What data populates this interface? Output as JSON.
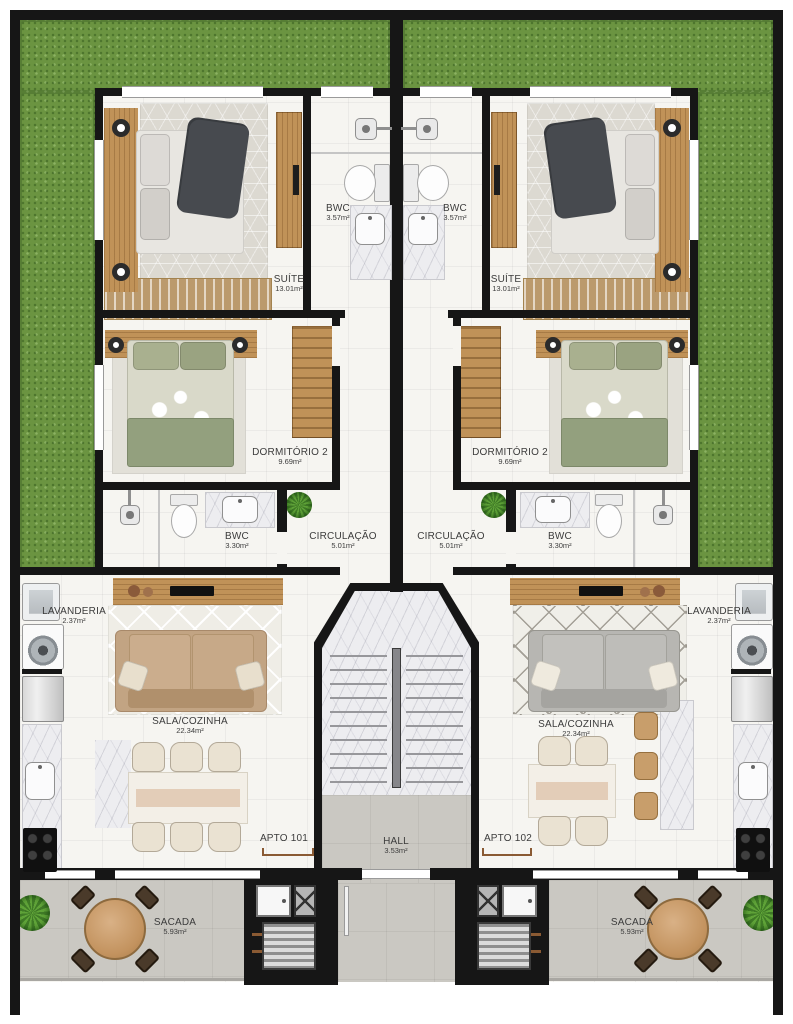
{
  "plan": {
    "hall": {
      "name": "HALL",
      "area": "3.53m²"
    },
    "units": [
      {
        "entry_label": "APTO 101",
        "rooms": {
          "suite": {
            "name": "SUÍTE",
            "area": "13.01m²"
          },
          "bwc_suite": {
            "name": "BWC",
            "area": "3.57m²"
          },
          "dormitorio2": {
            "name": "DORMITÓRIO 2",
            "area": "9.69m²"
          },
          "bwc2": {
            "name": "BWC",
            "area": "3.30m²"
          },
          "circulacao": {
            "name": "CIRCULAÇÃO",
            "area": "5.01m²"
          },
          "lavanderia": {
            "name": "LAVANDERIA",
            "area": "2.37m²"
          },
          "sala_cozinha": {
            "name": "SALA/COZINHA",
            "area": "22.34m²"
          },
          "sacada": {
            "name": "SACADA",
            "area": "5.93m²"
          }
        }
      },
      {
        "entry_label": "APTO 102",
        "rooms": {
          "suite": {
            "name": "SUÍTE",
            "area": "13.01m²"
          },
          "bwc_suite": {
            "name": "BWC",
            "area": "3.57m²"
          },
          "dormitorio2": {
            "name": "DORMITÓRIO 2",
            "area": "9.69m²"
          },
          "bwc2": {
            "name": "BWC",
            "area": "3.30m²"
          },
          "circulacao": {
            "name": "CIRCULAÇÃO",
            "area": "5.01m²"
          },
          "lavanderia": {
            "name": "LAVANDERIA",
            "area": "2.37m²"
          },
          "sala_cozinha": {
            "name": "SALA/COZINHA",
            "area": "22.34m²"
          },
          "sacada": {
            "name": "SACADA",
            "area": "5.93m²"
          }
        }
      }
    ],
    "colors": {
      "grass": "#6b9441",
      "wall": "#161616",
      "floor_tile": "#f6f5f1",
      "concrete": "#cac8c2",
      "wood": "#c09258",
      "door_marker": "#8a5a33",
      "sofa_unit1": "#c2a483",
      "sofa_unit2": "#b7b6b2",
      "bedding_suite": "#e8e6e1",
      "bedding_dorm2": "#a9b08f"
    }
  }
}
